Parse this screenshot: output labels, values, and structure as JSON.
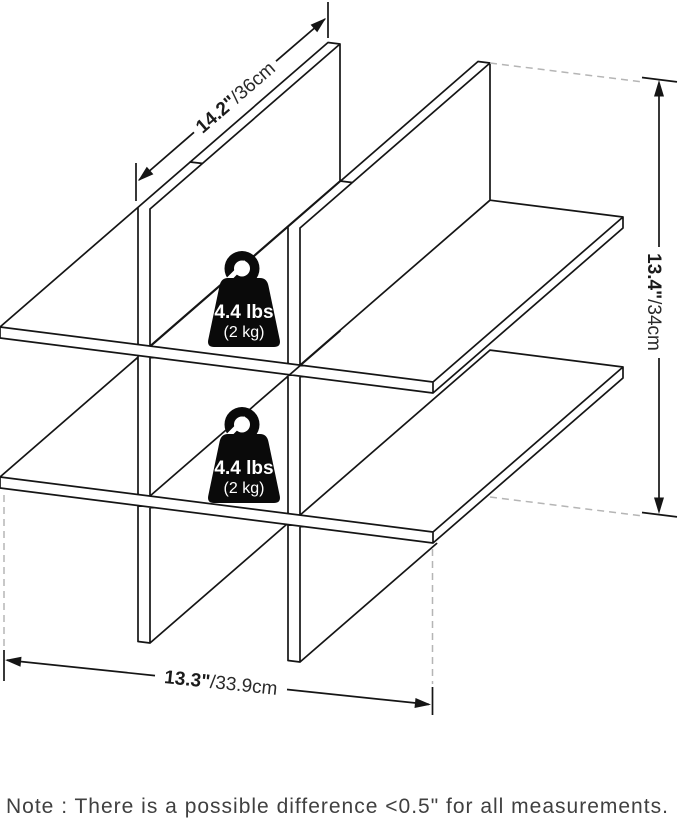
{
  "colors": {
    "line": "#151515",
    "dash": "#b5b5b5",
    "badge": "#0a0a0a",
    "note_text": "#404040"
  },
  "dimensions": {
    "depth": {
      "value": "14.2\"",
      "metric": "/36cm"
    },
    "height": {
      "value": "13.4\"",
      "metric": "/34cm"
    },
    "width": {
      "value": "13.3\"",
      "metric": "/33.9cm"
    }
  },
  "weight_badges": [
    {
      "weight": "4.4 lbs",
      "metric": "(2 kg)"
    },
    {
      "weight": "4.4 lbs",
      "metric": "(2 kg)"
    }
  ],
  "note": "Note : There is a possible difference <0.5\" for all measurements."
}
